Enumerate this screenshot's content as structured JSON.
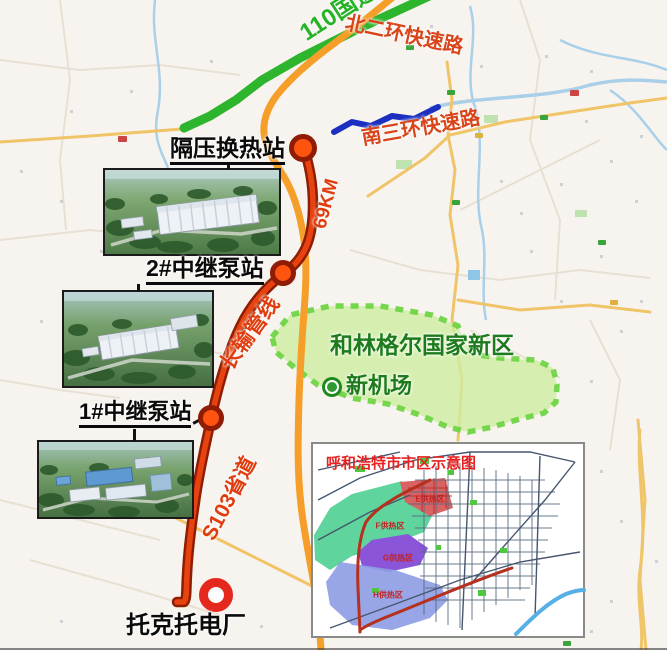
{
  "map": {
    "road_labels": {
      "national_110": "110国道",
      "north_ring_2": "北二环快速路",
      "south_ring_3": "南三环快速路",
      "s103": "S103省道"
    },
    "pipeline": {
      "distance": "69KM",
      "name": "长输管线"
    },
    "stations": {
      "heat_exchange": "隔压换热站",
      "pump_2": "2#中继泵站",
      "pump_1": "1#中继泵站",
      "power_plant": "托克托电厂"
    },
    "new_area": {
      "name": "和林格尔国家新区",
      "airport": "新机场"
    }
  },
  "inset": {
    "title": "呼和浩特市市区示意图",
    "zones": [
      {
        "label": "E供热区",
        "color": "#d96262"
      },
      {
        "label": "F供热区",
        "color": "#5fd49c"
      },
      {
        "label": "G供热区",
        "color": "#8a55d8"
      },
      {
        "label": "H供热区",
        "color": "#8f9de4"
      }
    ]
  },
  "colors": {
    "pipeline": "#e64310",
    "road_green": "#2eb52e",
    "road_orange": "#f59f2a",
    "road_blue": "#1c2fc0",
    "new_area_fill": "#cdeea0",
    "label_red": "#d9441a",
    "label_green": "#1d7a1d"
  }
}
